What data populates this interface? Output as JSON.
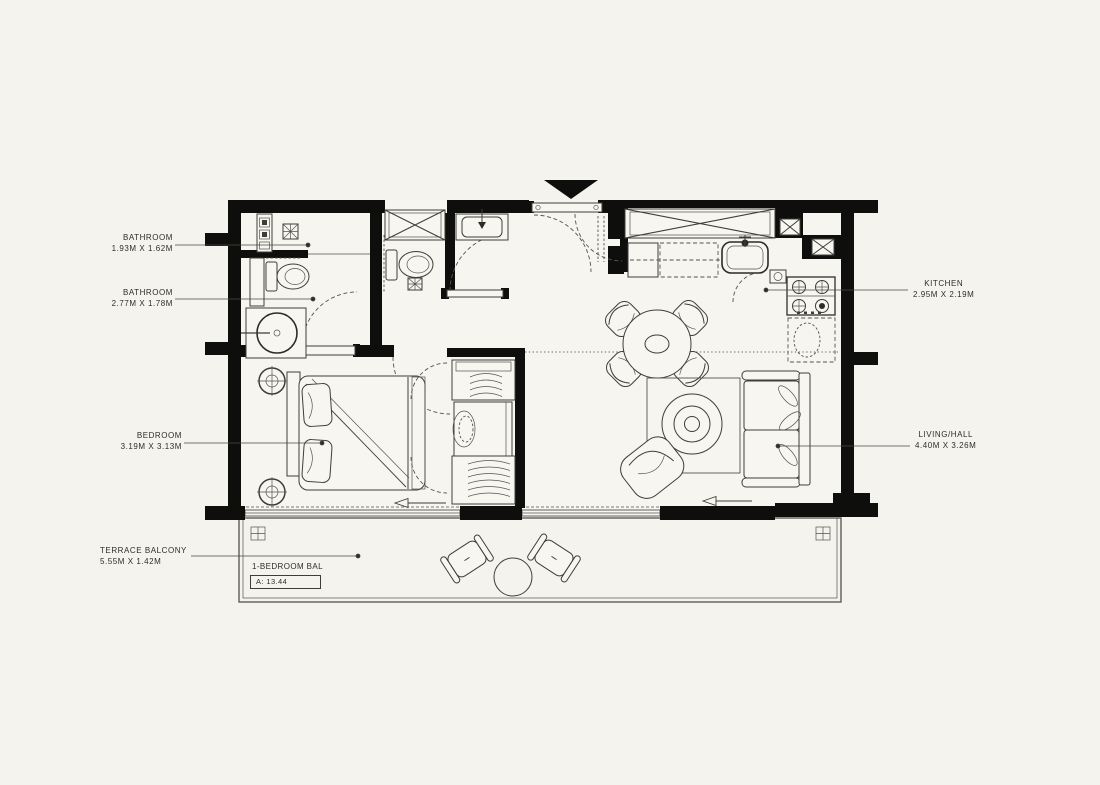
{
  "canvas": {
    "background": "#f4f3ee",
    "wall_color": "#0e0e0c",
    "line_color": "#3f3d38",
    "label_color": "#2e2d29"
  },
  "unit": {
    "type_label": "1-BEDROOM BAL",
    "area_label": "A: 13.44"
  },
  "labels": [
    {
      "id": "bathroom-1",
      "name": "BATHROOM",
      "dims": "1.93M X 1.62M"
    },
    {
      "id": "bathroom-2",
      "name": "BATHROOM",
      "dims": "2.77M X 1.78M"
    },
    {
      "id": "bedroom",
      "name": "BEDROOM",
      "dims": "3.19M X 3.13M"
    },
    {
      "id": "terrace",
      "name": "TERRACE BALCONY",
      "dims": "5.55M X 1.42M"
    },
    {
      "id": "kitchen",
      "name": "KITCHEN",
      "dims": "2.95M X 2.19M"
    },
    {
      "id": "living",
      "name": "LIVING/HALL",
      "dims": "4.40M X 3.26M"
    }
  ],
  "icons": {
    "entry_marker": "filled-down-triangle",
    "floor_drain": "crossed-square",
    "shaft": "x-box",
    "door_slide_arrow": "left-arrow"
  }
}
